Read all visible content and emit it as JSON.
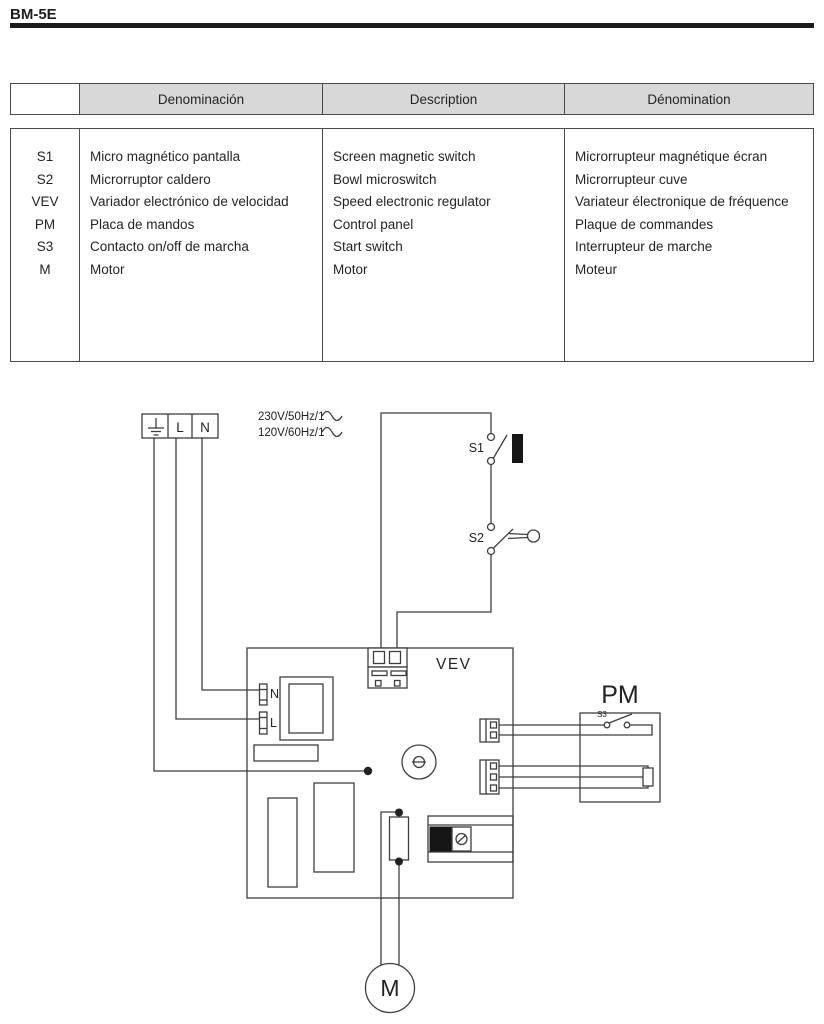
{
  "page": {
    "model_code": "BM-5E"
  },
  "legend_table": {
    "headers": {
      "symbol": "",
      "es": "Denominación",
      "en": "Description",
      "fr": "Dénomination"
    },
    "rows": [
      {
        "symbol": "S1",
        "es": "Micro magnético pantalla",
        "en": "Screen magnetic switch",
        "fr": "Microrrupteur magnétique écran"
      },
      {
        "symbol": "S2",
        "es": "Microrruptor caldero",
        "en": "Bowl microswitch",
        "fr": "Microrrupteur cuve"
      },
      {
        "symbol": "VEV",
        "es": "Variador electrónico de velocidad",
        "en": "Speed electronic regulator",
        "fr": "Variateur électronique de fréquence"
      },
      {
        "symbol": "PM",
        "es": "Placa de mandos",
        "en": "Control panel",
        "fr": "Plaque de commandes"
      },
      {
        "symbol": "S3",
        "es": "Contacto on/off de marcha",
        "en": "Start switch",
        "fr": "Interrupteur de marche"
      },
      {
        "symbol": "M",
        "es": "Motor",
        "en": "Motor",
        "fr": "Moteur"
      }
    ]
  },
  "diagram": {
    "supply": {
      "line1": "230V/50Hz/1",
      "line2": "120V/60Hz/1"
    },
    "mains_block": {
      "live": "L",
      "neutral": "N"
    },
    "vev_board": {
      "title": "VEV",
      "neutral_terminal": "N",
      "live_terminal": "L"
    },
    "switches": {
      "s1": "S1",
      "s2": "S2",
      "s3": "S3"
    },
    "control_panel": {
      "title": "PM"
    },
    "motor": {
      "label": "M"
    },
    "colors": {
      "line": "#3e3e3e",
      "text": "#222222",
      "table_header_bg": "#d8d8d8",
      "rule": "#1b1b1b"
    }
  }
}
